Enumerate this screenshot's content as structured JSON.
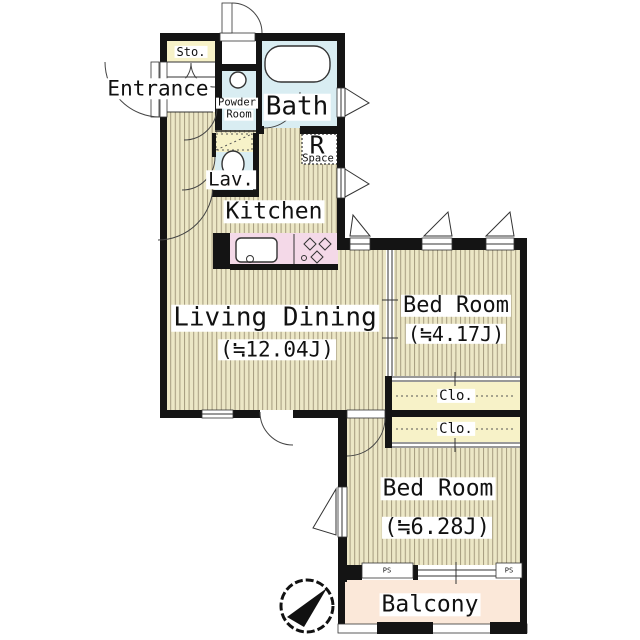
{
  "floorplan": {
    "rooms": {
      "storage": {
        "label": "Sto."
      },
      "entrance": {
        "label": "Entrance"
      },
      "powder_room": {
        "line1": "Powder",
        "line2": "Room"
      },
      "bath": {
        "label": "Bath"
      },
      "lavatory": {
        "label": "Lav."
      },
      "refrigerator_space": {
        "line1": "R",
        "line2": "Space"
      },
      "kitchen": {
        "label": "Kitchen"
      },
      "living_dining": {
        "label": "Living Dining",
        "area": "(≒12.04J)"
      },
      "bedroom_small": {
        "label": "Bed Room",
        "area": "(≒4.17J)"
      },
      "closet_upper": {
        "label": "Clo."
      },
      "closet_lower": {
        "label": "Clo."
      },
      "bedroom_large": {
        "label": "Bed Room",
        "area": "(≒6.28J)"
      },
      "pipe_shaft_left": {
        "label": "PS"
      },
      "pipe_shaft_right": {
        "label": "PS"
      },
      "balcony": {
        "label": "Balcony"
      }
    },
    "icons": {
      "compass": "north-arrow"
    },
    "colors": {
      "wall": "#141414",
      "tatami": "#ece7c6",
      "stripe": "#a59c7f",
      "closet": "#f7f2c8",
      "water": "#d9edf2",
      "counter": "#f4d9e8",
      "balcony": "#fbe8d9"
    }
  }
}
